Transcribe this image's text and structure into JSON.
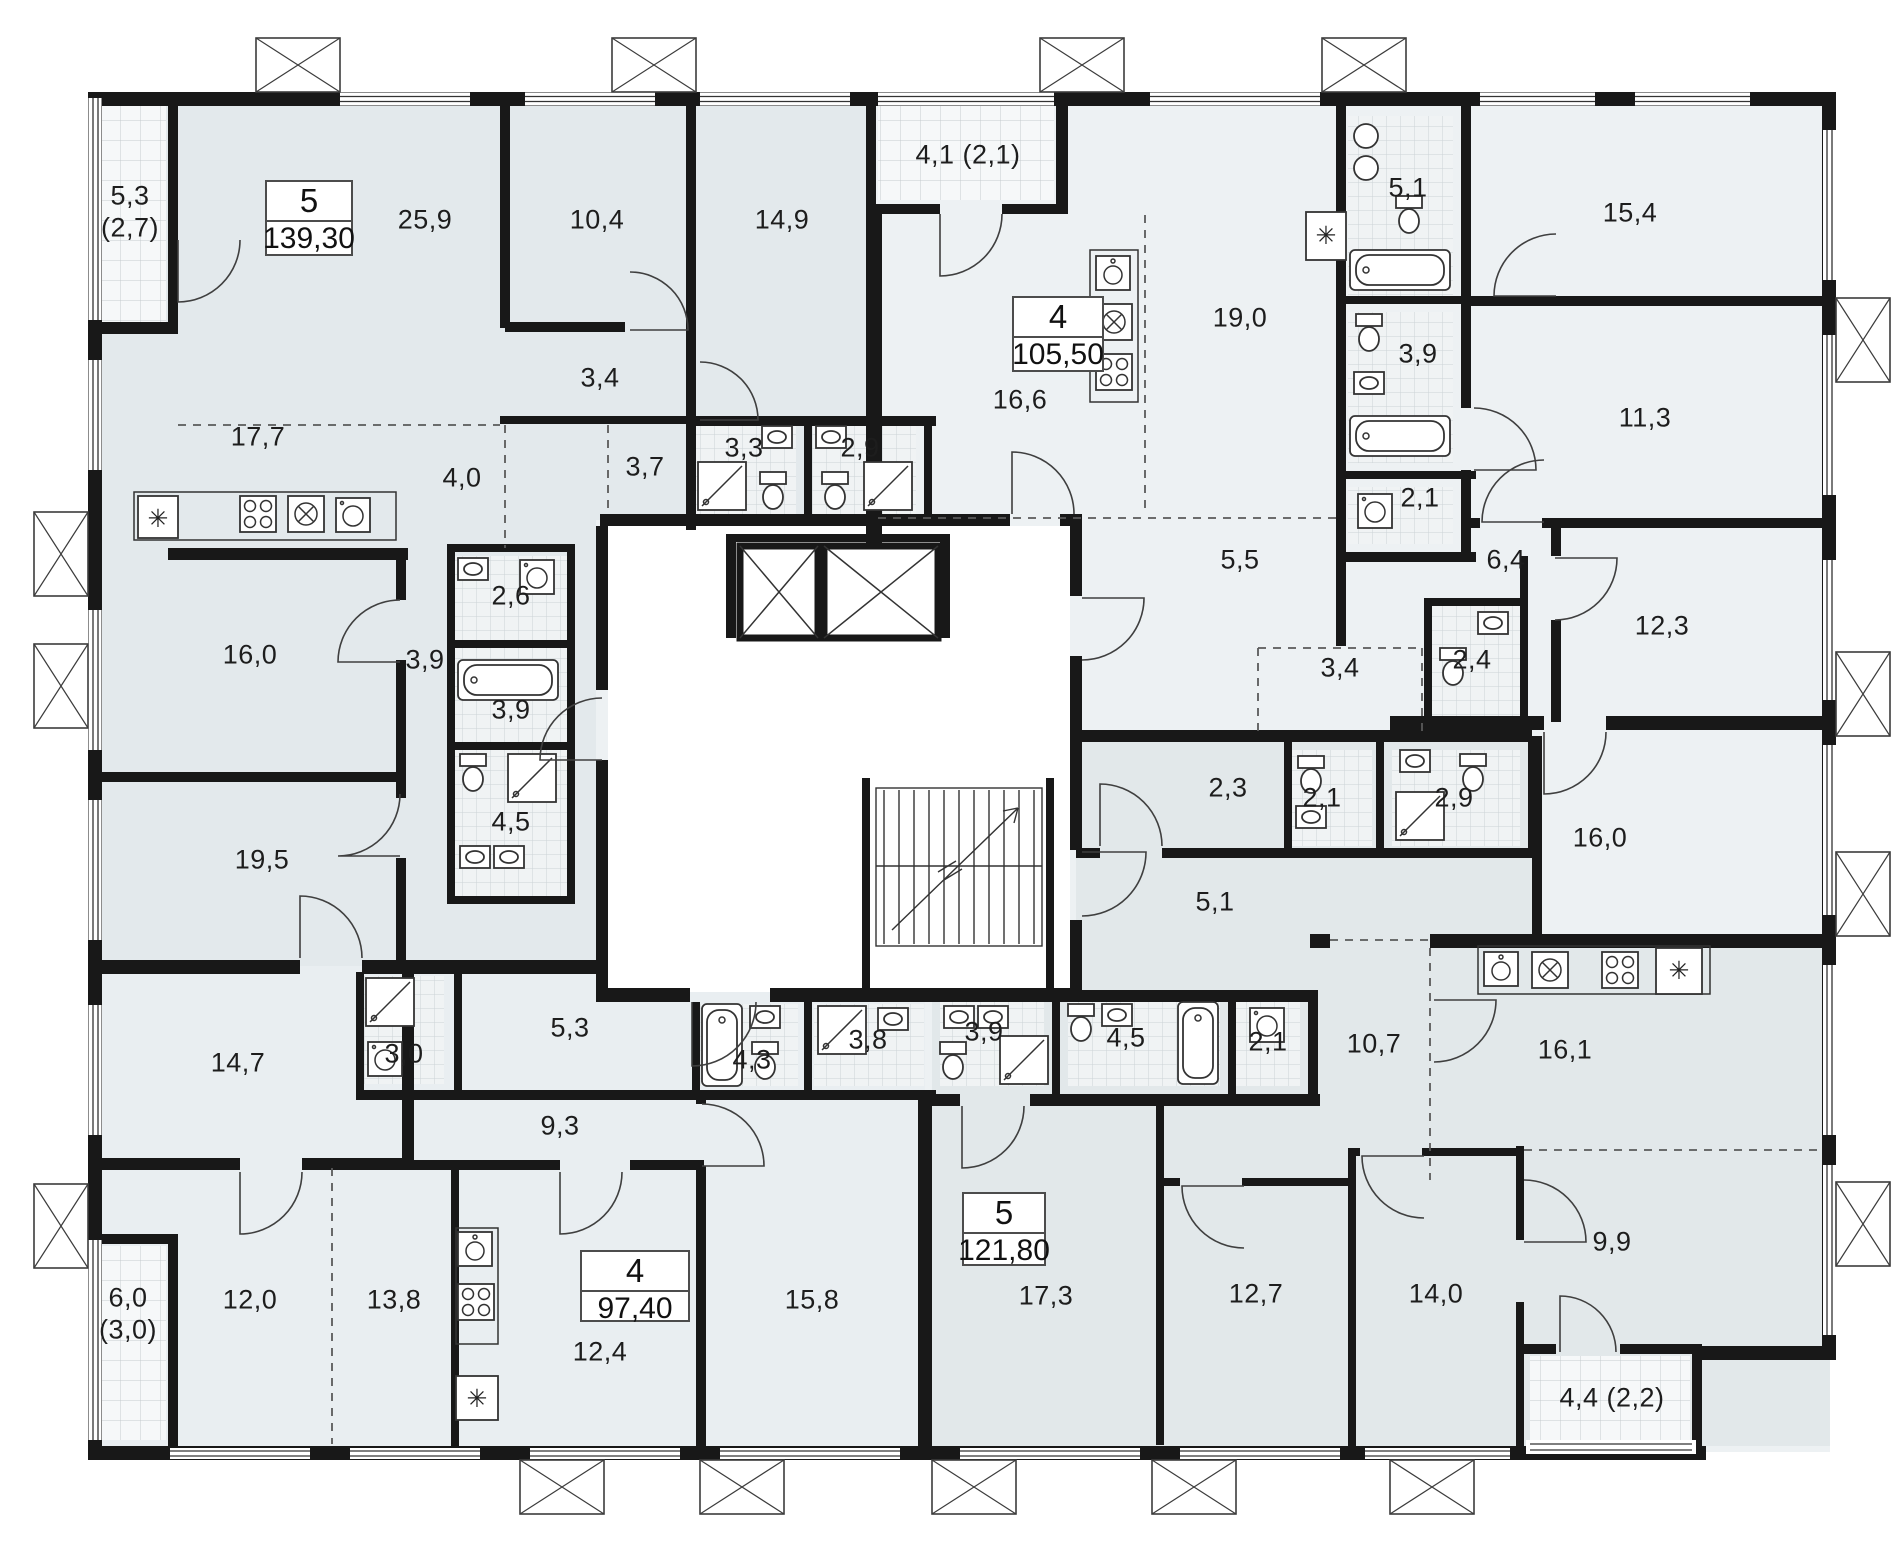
{
  "apartments": [
    {
      "rooms_count": "5",
      "total_area": "139,30"
    },
    {
      "rooms_count": "4",
      "total_area": "105,50"
    },
    {
      "rooms_count": "4",
      "total_area": "97,40"
    },
    {
      "rooms_count": "5",
      "total_area": "121,80"
    }
  ],
  "room_areas": [
    "5,3",
    "(2,7)",
    "25,9",
    "10,4",
    "14,9",
    "3,4",
    "17,7",
    "4,0",
    "3,7",
    "3,3",
    "2,9",
    "2,6",
    "3,9",
    "3,9",
    "16,0",
    "19,5",
    "4,5",
    "4,1 (2,1)",
    "16,6",
    "19,0",
    "5,1",
    "15,4",
    "3,9",
    "2,1",
    "11,3",
    "5,5",
    "3,4",
    "2,4",
    "6,4",
    "12,3",
    "14,7",
    "3,0",
    "5,3",
    "9,3",
    "4,3",
    "3,8",
    "6,0",
    "(3,0)",
    "12,0",
    "13,8",
    "12,4",
    "15,8",
    "2,3",
    "2,1",
    "2,9",
    "5,1",
    "3,9",
    "4,5",
    "2,1",
    "10,7",
    "16,0",
    "16,1",
    "17,3",
    "12,7",
    "14,0",
    "9,9",
    "4,4 (2,2)"
  ],
  "symbols": {
    "fridge": "✳"
  }
}
